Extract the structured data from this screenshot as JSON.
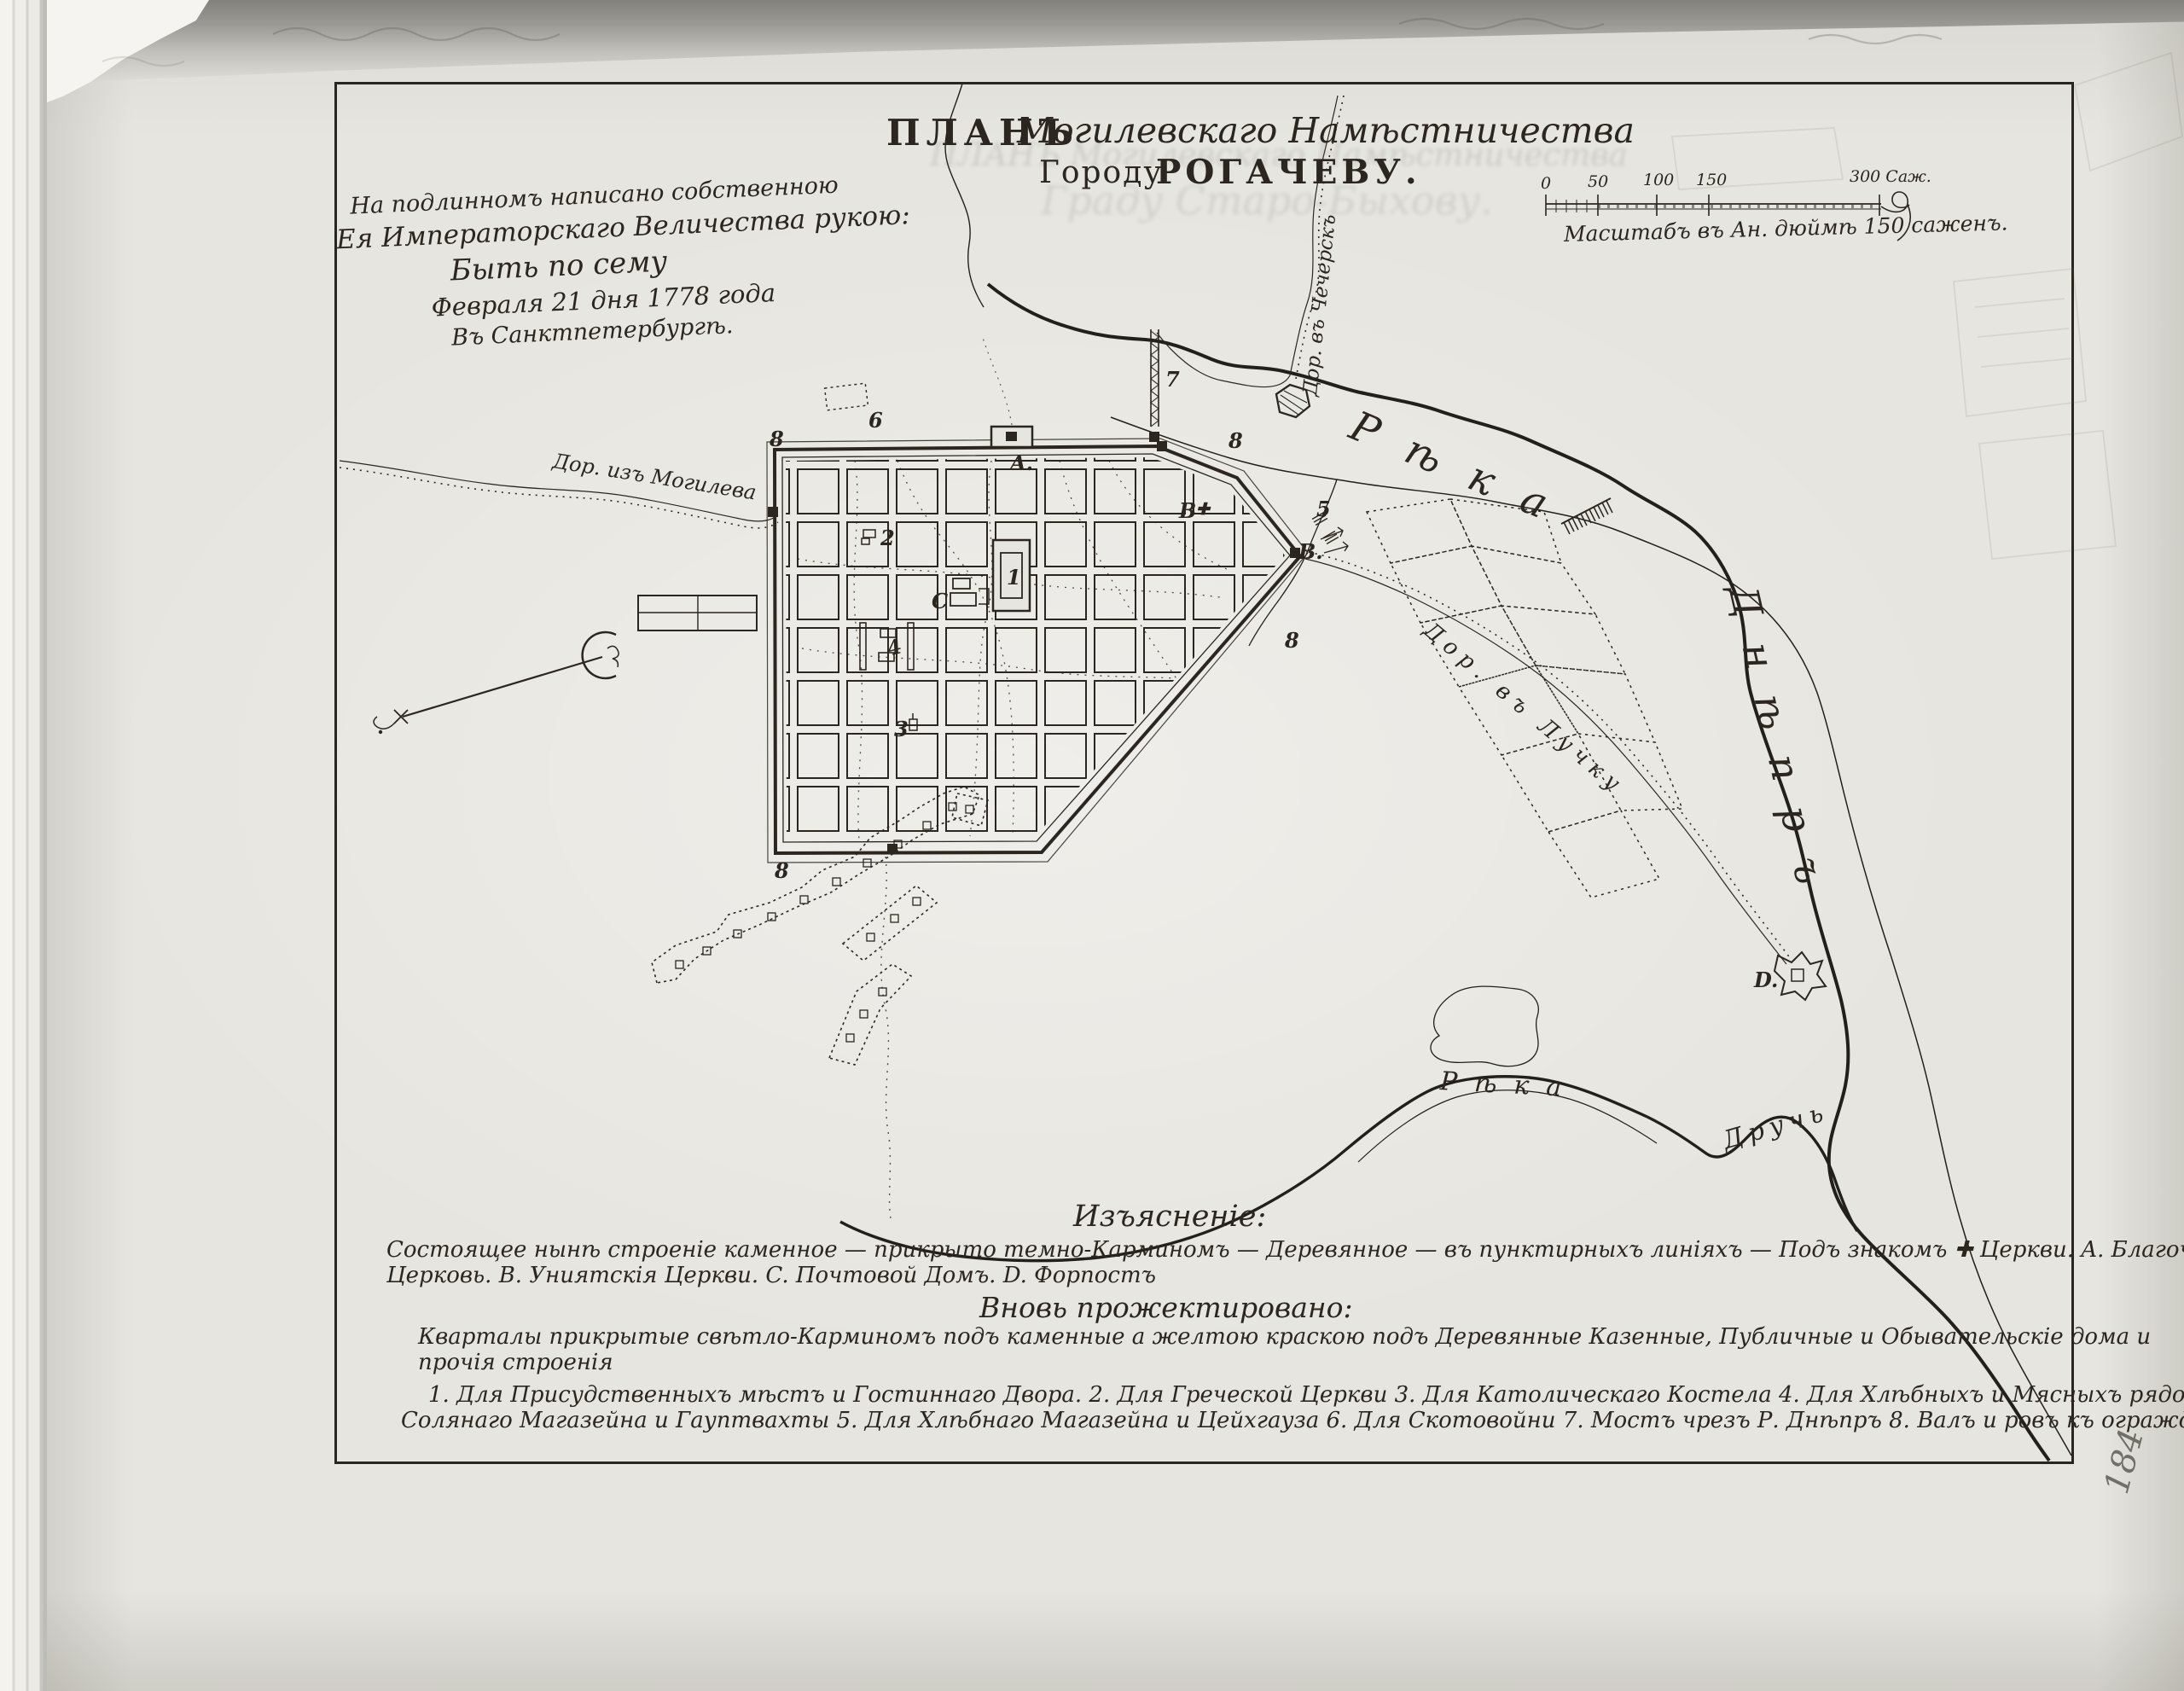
{
  "title": {
    "word_plan": "ПЛАНЪ",
    "script_part": "Могилевскаго Намѣстничества",
    "line2_lead": "Городу",
    "line2_name": "РОГАЧЕВУ."
  },
  "ghost_bleed": {
    "line1": "ПЛАНЪ Могилевскаго Намѣстничества",
    "line2": "Граду Старо-Быхову."
  },
  "imperial_note": {
    "line1": "На подлинномъ написано собственною",
    "line2": "Ея Императорскаго Величества рукою:",
    "line3": "Быть по сему",
    "line4": "Февраля 21 дня 1778 года",
    "line5": "Въ Санктпетербургѣ."
  },
  "scale_bar": {
    "tick0": "0",
    "tick50": "50",
    "tick100": "100",
    "tick150": "150",
    "tick300": "300 Саж.",
    "caption": "Масштабъ въ Ан. дюймѣ 150 саженъ."
  },
  "map_labels": {
    "road_mogilev": "Дор. изъ Могилева",
    "road_chechersk": "Дор. въ Чечерскъ",
    "road_luchku": "Дор. въ Лучку",
    "dnieper_word1": "Рѣка",
    "dnieper_word2": "Днѣпръ",
    "druch_word1": "Рѣка",
    "druch_word2": "Дручь",
    "marker_a": "A.",
    "marker_b_town": "B",
    "marker_b_cross": "✚",
    "marker_b_east": "B.",
    "marker_c": "C",
    "marker_d": "D.",
    "num1": "1",
    "num2": "2",
    "num3": "3",
    "num4": "4",
    "num5": "5",
    "num6": "6",
    "num7": "7",
    "num8_nw": "8",
    "num8_ne": "8",
    "num8_e": "8",
    "num8_sw": "8"
  },
  "legend": {
    "heading1": "Изъясненіе:",
    "line1": "Состоящее нынѣ строеніе каменное — прикрыто темно-Карминомъ — Деревянное — въ пунктирныхъ линіяхъ — Подъ знакомъ ✚ Церкви. A. Благочестивая",
    "line2": "Церковь. B. Униятскія Церкви. C. Почтовой Домъ. D. Форпостъ",
    "heading2": "Вновь прожектировано:",
    "line3": "Кварталы прикрытые свѣтло-Карминомъ подъ каменные а желтою краскою подъ Деревянные Казенные, Публичные и Обывательскіе дома и",
    "line4": "прочія строенія",
    "line5": "1. Для Присудственныхъ мѣстъ и Гостиннаго Двора. 2. Для Греческой Церкви 3. Для Католическаго Костела 4. Для Хлѣбныхъ и Мясныхъ рядовъ,",
    "line6": "Солянаго Магазейна и Гауптвахты 5. Для Хлѣбнаго Магазейна и Цейхгауза 6. Для Скотовойни 7. Мостъ чрезъ Р. Днѣпръ 8. Валъ и ровъ къ огражденію Города."
  },
  "annotations": {
    "page_number_pencil": "184"
  }
}
